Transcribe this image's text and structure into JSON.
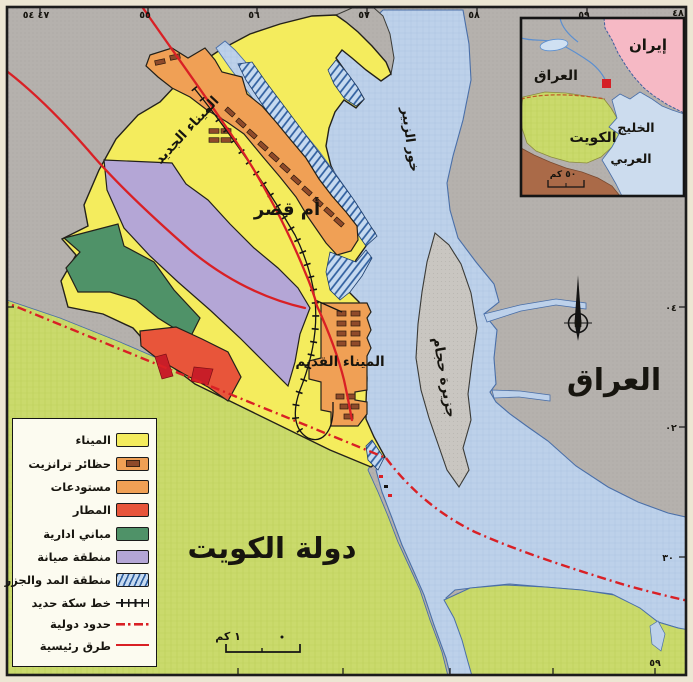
{
  "map": {
    "labels": {
      "new_port": "الميناء الجديد",
      "umm_qasr": "أم قصر",
      "old_port": "الميناء القديم",
      "khor_zubair": "خور الزبير",
      "hajjam_island": "جزيرة حجام",
      "iraq": "العراق",
      "kuwait_state": "دولة الكويت",
      "scale_label": "١ كم",
      "compass_letter": "N"
    },
    "coordinates": {
      "top": [
        "٤٧ ٥٤",
        "٥٥",
        "٥٦",
        "٥٧",
        "٥٨",
        "٥٩",
        "٤٨"
      ],
      "right": [
        "٠٤",
        "٠٢",
        "٣٠"
      ],
      "bottom": [
        "٥٩"
      ]
    }
  },
  "legend": {
    "items": [
      {
        "label": "الميناء",
        "color": "#f4ec5d"
      },
      {
        "label": "حظائر ترانزيت",
        "color": "#f0a055"
      },
      {
        "label": "مستودعات",
        "color": "#f0a055"
      },
      {
        "label": "المطار",
        "color": "#e8553a"
      },
      {
        "label": "مباني ادارية",
        "color": "#4f9268"
      },
      {
        "label": "منطقة صيانة",
        "color": "#b4a6d6"
      },
      {
        "label": "منطقة المد والجزر",
        "color": "#c6daf0"
      },
      {
        "label": "خط سكة حديد",
        "color": "#141414"
      },
      {
        "label": "حدود دولية",
        "color": "#d92025"
      },
      {
        "label": "طرق رئيسية",
        "color": "#d92025"
      }
    ]
  },
  "inset": {
    "labels": {
      "iran": "إيران",
      "iraq": "العراق",
      "kuwait": "الكويت",
      "gulf_line1": "الخليج",
      "gulf_line2": "العربي",
      "scale_label": "٥٠ كم"
    }
  },
  "colors": {
    "iraq_land": "#b5b1ad",
    "water": "#bdd1ea",
    "kuwait_land": "#cada6c",
    "port_yellow": "#f4ec5d",
    "warehouse_orange": "#f0a055",
    "hangar_brown": "#8f4a2a",
    "airport_red": "#e8553a",
    "admin_green": "#4f9268",
    "maintenance_purple": "#b4a6d6",
    "tidal_blue": "#2e5e9e",
    "road_red": "#d92025",
    "iran_pink": "#f6b9c5",
    "saudi_brown": "#aa6a48",
    "island_gray": "#c9c6c1"
  }
}
